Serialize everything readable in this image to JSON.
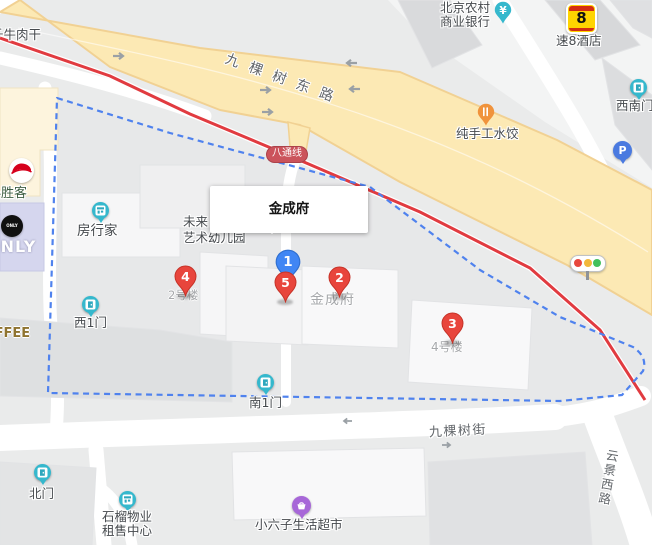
{
  "colors": {
    "road_yellow": "#fce9b4",
    "rail_red": "#e13b40",
    "boundary_blue": "#4f82ee",
    "marker_red": "#e8453c",
    "marker_blue": "#4086f4",
    "poi_teal": "#35b8cd",
    "poi_orange": "#f0933c",
    "poi_purple": "#a767d8",
    "super8_yellow": "#ffd400",
    "badge_red": "#cb535b"
  },
  "roads": {
    "east_road": "九棵树东路",
    "street": "九棵树街",
    "west_road": "云景西路"
  },
  "subway_badge": "八通线",
  "info_box": {
    "title": "金成府"
  },
  "markers": {
    "m1": "1",
    "m2": "2",
    "m3": "3",
    "m4": "4",
    "m5": "5"
  },
  "building_labels": {
    "b2": "2号楼",
    "b4": "4号楼",
    "jinchengfu": "金成府"
  },
  "pois": {
    "beef_jerky": "千牛肉干",
    "bank_line1": "北京农村",
    "bank_line2": "商业银行",
    "bank_symbol": "¥",
    "hotel": "速8酒店",
    "hotel_logo": "8",
    "sw_gate": "西南门",
    "dumplings": "纯手工水饺",
    "fangxingjia": "房行家",
    "kindergarten_line1": "未来",
    "kindergarten_line2": "艺术幼儿园",
    "w_gate": "西1门",
    "s_gate": "南1门",
    "n_gate": "北门",
    "property_line1": "石榴物业",
    "property_line2": "租售中心",
    "supermarket": "小六子生活超市",
    "pizza_hut": "必胜客",
    "only": "ONLY",
    "coffee": "COFFEE",
    "parking": "P"
  }
}
